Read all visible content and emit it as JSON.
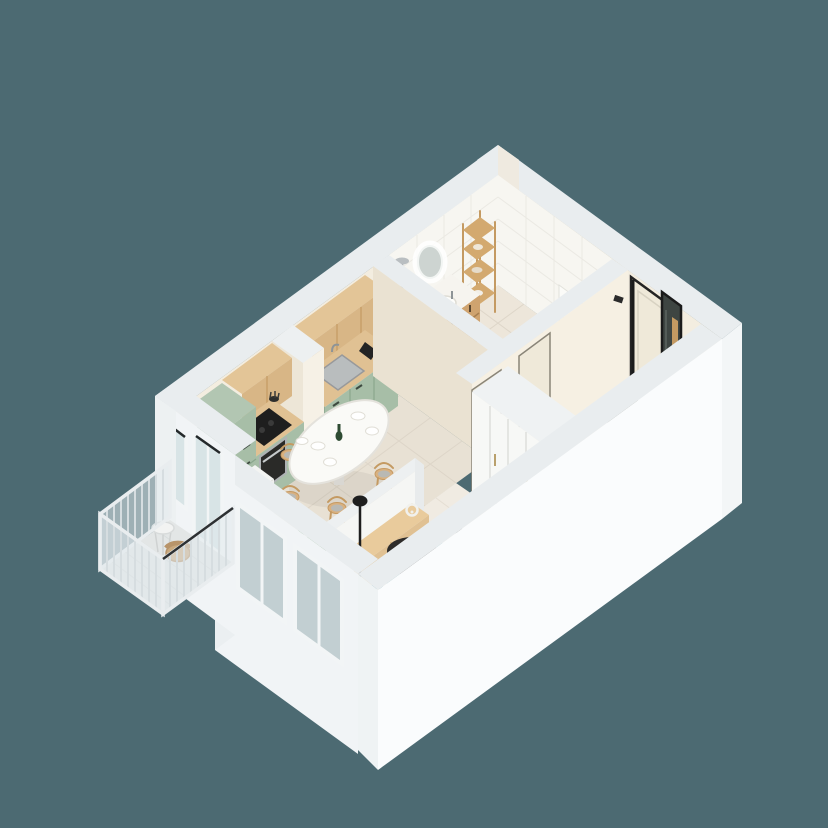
{
  "scene": {
    "type": "isometric-3d-floor-plan-render",
    "background_color": "#4C6A72",
    "palette": {
      "wall_white": "#FAFCFD",
      "wall_white_shade": "#F1F4F6",
      "wall_top": "#E9EDEF",
      "wall_cream": "#F3EDE0",
      "wall_cream_shade": "#EAE2D2",
      "tile_white": "#F7F6F1",
      "floor_tile": "#E8E1D4",
      "floor_tile_bath": "#EDE6DA",
      "floor_wood": "#F0EBE2",
      "balcony_floor": "#E3E6E6",
      "cabinet_green": "#A7BEA7",
      "cabinet_green_dark": "#93AD96",
      "counter_wood": "#E0C193",
      "upper_wood": "#D8B686",
      "vanity_wood": "#CFA36F",
      "sofa_gray": "#CFCDC9",
      "sofa_gray_dark": "#C6C4C0",
      "pillow_sage": "#ACBFAE",
      "armchair_tan": "#DFAD7C",
      "armchair_tan_dark": "#D29A66",
      "rug_charcoal": "#53534D",
      "rug_teal": "#4F8D96",
      "rug_teal_light": "#67A3AA",
      "rug_cream": "#EAE5D6",
      "rug_gray": "#97958D",
      "rug_olive": "#6B6B52",
      "coffee_table_black": "#2E2C2A",
      "door_cream": "#EFE9D9",
      "frame_black": "#242424",
      "mirror_dark": "#3E4542",
      "doormat_green": "#70766A",
      "plant_green": "#5E8A5C",
      "wicker_tan": "#C9A97E",
      "white_fixture": "#FBFBF8",
      "steel_gray": "#9AA0A3"
    },
    "rooms": [
      {
        "name": "bathroom",
        "furniture": [
          "shower-column",
          "round-led-mirror",
          "wood-vanity-with-sink",
          "ladder-shelf",
          "wall-hung-toilet"
        ]
      },
      {
        "name": "kitchen",
        "furniture": [
          "upper-wood-cabinets",
          "green-base-cabinets",
          "cooktop",
          "oven",
          "sink",
          "coffee-machine",
          "tall-fridge-cabinet",
          "white-storage-cabinet"
        ]
      },
      {
        "name": "dining-area",
        "furniture": [
          "oval-white-table",
          "wood-chair",
          "wood-chair",
          "wood-chair",
          "wood-chair",
          "wood-chair",
          "wine-bottle",
          "plates"
        ]
      },
      {
        "name": "living-room",
        "furniture": [
          "geometric-rug",
          "gray-sofa",
          "sage-pillows",
          "leather-armchair",
          "round-coffee-table",
          "floor-lamp",
          "tv-console",
          "headphones",
          "potted-plant"
        ]
      },
      {
        "name": "hallway",
        "furniture": [
          "entrance-door",
          "tall-mirror",
          "doormat",
          "white-wardrobe",
          "white-storage-box",
          "bathroom-door",
          "living-room-door"
        ]
      },
      {
        "name": "balcony",
        "furniture": [
          "glass-railing",
          "wicker-chair",
          "wire-table",
          "glass-door",
          "window"
        ]
      }
    ]
  }
}
